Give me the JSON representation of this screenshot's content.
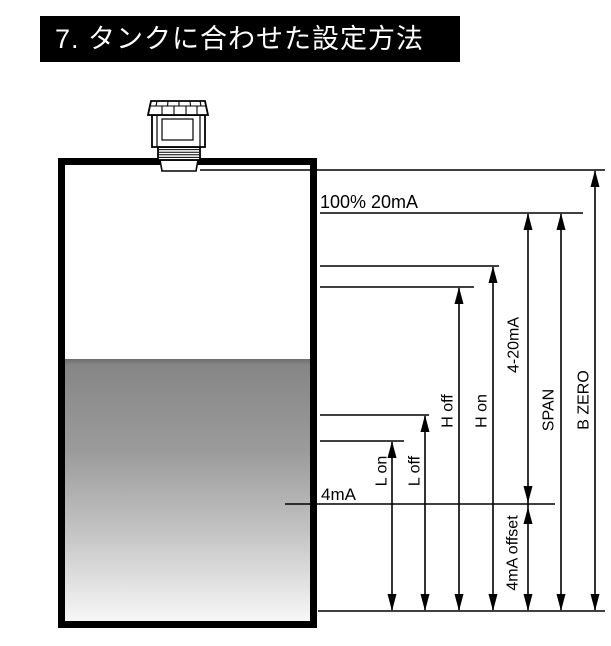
{
  "header": {
    "title": "7. タンクに合わせた設定方法"
  },
  "diagram": {
    "levels": {
      "full_level": "100% 20mA",
      "empty_level": "4mA"
    },
    "measurements": {
      "l_on": "L on",
      "l_off": "L off",
      "h_off": "H off",
      "h_on": "H on",
      "current_range": "4-20mA",
      "span": "SPAN",
      "b_zero": "B ZERO",
      "offset": "4mA offset"
    },
    "colors": {
      "line": "#000000",
      "header_bg": "#000000",
      "header_text": "#ffffff",
      "liquid_top": "#868686",
      "liquid_bottom": "#f7f7f7"
    }
  }
}
